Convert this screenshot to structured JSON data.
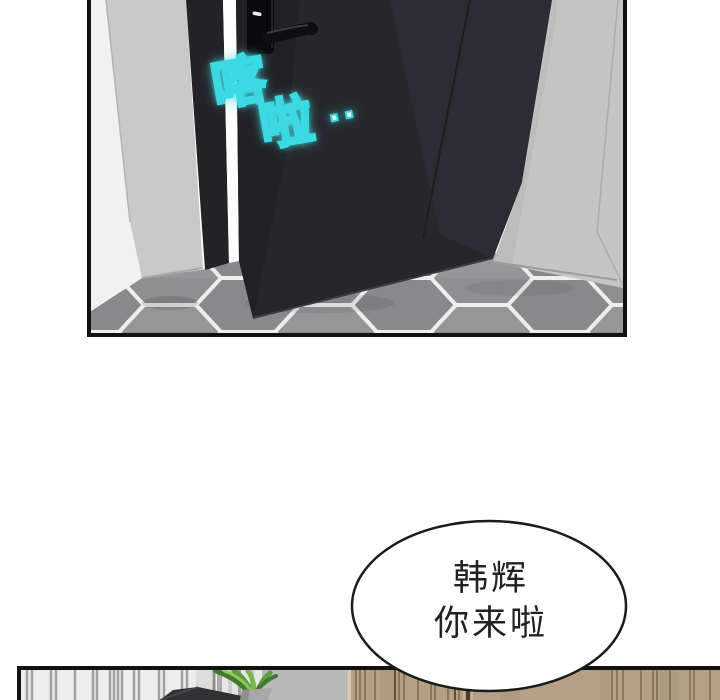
{
  "sfx": {
    "word1": "喀",
    "word2": "啦",
    "dots": "··"
  },
  "bubble": {
    "line1": "韩辉",
    "line2": "你来啦"
  },
  "colors": {
    "sfx_fill": "#ffffff",
    "sfx_outline": "#3bd9e2",
    "bubble_outline": "#1b1b1b",
    "bubble_text": "#222222",
    "panel_border": "#111111",
    "door": "#27272b",
    "left_wall": "#c9c9c9",
    "right_wall": "#c5c5c5",
    "floor_tile": "#8d8f90",
    "grout": "#eeeeee",
    "wood_wall": "#b3a087",
    "plant_green": "#76b84e"
  }
}
